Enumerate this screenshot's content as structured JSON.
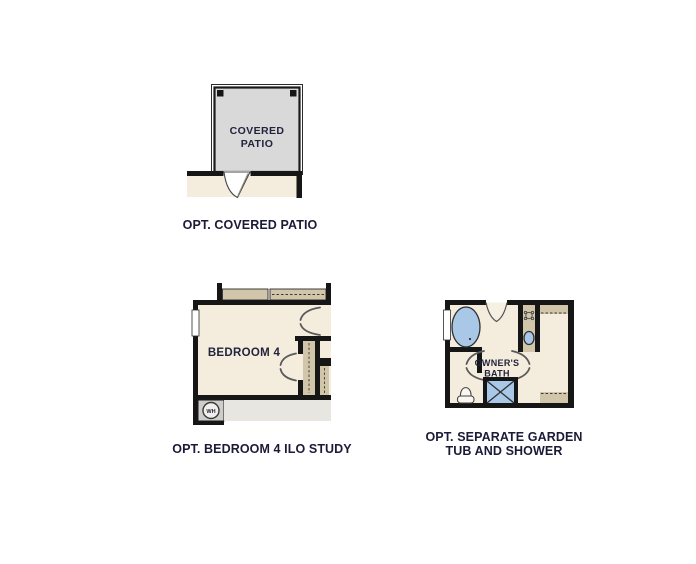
{
  "canvas": {
    "width": 696,
    "height": 564,
    "background": "#ffffff"
  },
  "colors": {
    "wall": "#161616",
    "interior_cream": "#f4edde",
    "cabinet_tan": "#d1c5aa",
    "patio_gray": "#d9d9d9",
    "floor_gray": "#e8e6e1",
    "water_heater_gray": "#cfcdc9",
    "fixture_blue": "#a9c7e6",
    "label_text": "#1b1b38"
  },
  "plans": {
    "covered_patio": {
      "room_label_line1": "COVERED",
      "room_label_line2": "PATIO",
      "caption": "OPT. COVERED PATIO"
    },
    "bedroom4": {
      "room_label": "BEDROOM 4",
      "water_heater_label": "WH",
      "caption": "OPT. BEDROOM 4 ILO STUDY"
    },
    "owners_bath": {
      "room_label_line1": "OWNER'S",
      "room_label_line2": "BATH",
      "caption_line1": "OPT. SEPARATE GARDEN",
      "caption_line2": "TUB AND SHOWER"
    }
  }
}
